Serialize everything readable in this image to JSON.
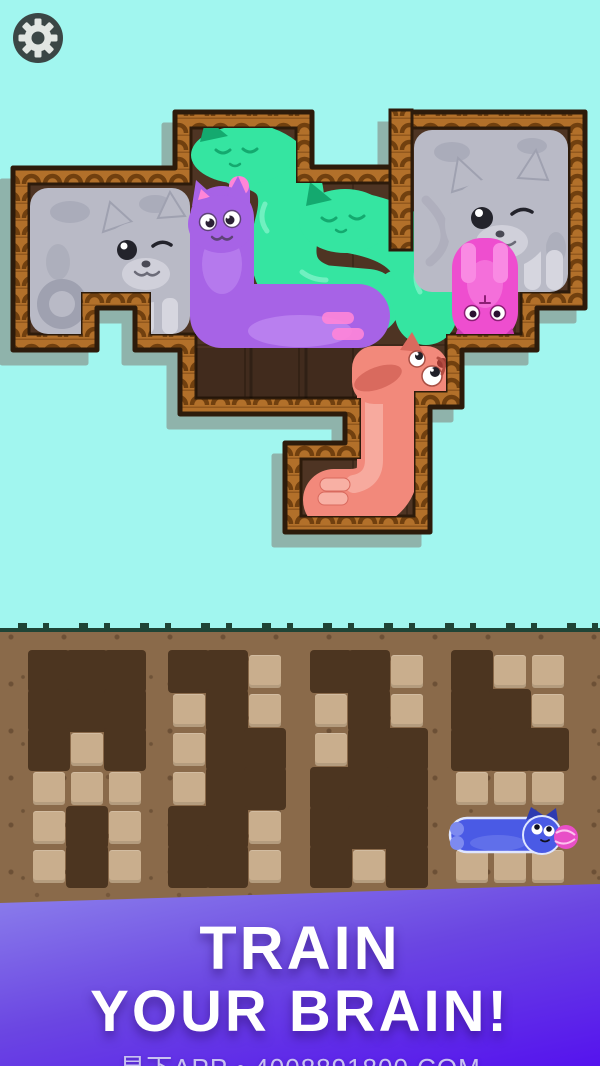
{
  "toolbar": {
    "settings_icon": "gear"
  },
  "banner": {
    "line1": "TRAIN",
    "line2": "YOUR BRAIN!",
    "subtext": "易下APP • 4008891800.COM"
  },
  "colors": {
    "sky": "#a1f6ef",
    "shadow": "#8fb3ab",
    "wood": "#b2702a",
    "wood-dark": "#71400f",
    "wood-outline": "#2d1b0b",
    "board": "#4e3423",
    "gray": "#b9bac6",
    "gray-dark": "#9fa1b0",
    "gray-light": "#d6d6df",
    "teal": "#35e5a1",
    "teal-dark": "#14a96f",
    "teal-light": "#7ff2c8",
    "purple": "#a763e6",
    "purple-light": "#c18cf2",
    "pink-accent": "#ff85d8",
    "pinkcat": "#ee4ecf",
    "pinkcat-light": "#f98ae3",
    "salmon": "#f2897b",
    "salmon-dark": "#d96a5e",
    "salmon-light": "#f8b0a4",
    "blue": "#4a5ae5",
    "blue-dark": "#2e3bb0",
    "blue-light": "#7d8af0",
    "yarn": "#e84fc7",
    "dirt": "#8a6a4a",
    "dirt-dark": "#4c3520",
    "tile": "#c9ae8d",
    "grass": "#1f4436",
    "banner-top": "#8d82ec",
    "banner-mid": "#6b46e2",
    "banner-bottom": "#5513ee",
    "footer-text": "#c9c2f1",
    "gear-bg": "#3b4645",
    "gear-fg": "#e2e6e2"
  },
  "board": {
    "empty_middle_cells": 3,
    "pieces": [
      {
        "id": "gray-cat-left",
        "color_key": "gray"
      },
      {
        "id": "teal-cat-top",
        "color_key": "teal"
      },
      {
        "id": "purple-cat",
        "color_key": "purple"
      },
      {
        "id": "teal-cat-right",
        "color_key": "teal"
      },
      {
        "id": "gray-cat-right",
        "color_key": "gray"
      },
      {
        "id": "pink-cat",
        "color_key": "pinkcat"
      },
      {
        "id": "salmon-cat",
        "color_key": "salmon"
      },
      {
        "id": "blue-cat",
        "color_key": "blue"
      }
    ]
  },
  "ground": {
    "cell_w": 38,
    "cell_h": 39,
    "panel_top": 652,
    "panels": [
      {
        "id": "panel-1",
        "x": 30,
        "rows": [
          [
            "d",
            "d",
            "d"
          ],
          [
            "d",
            "d",
            "d"
          ],
          [
            "d",
            "t",
            "d"
          ],
          [
            "t",
            "t",
            "t"
          ],
          [
            "t",
            "d",
            "t"
          ],
          [
            "t",
            "d",
            "t"
          ]
        ]
      },
      {
        "id": "panel-2",
        "x": 170,
        "rows": [
          [
            "d",
            "d",
            "t"
          ],
          [
            "t",
            "d",
            "t"
          ],
          [
            "t",
            "d",
            "d"
          ],
          [
            "t",
            "d",
            "d"
          ],
          [
            "d",
            "d",
            "t"
          ],
          [
            "d",
            "d",
            "t"
          ]
        ]
      },
      {
        "id": "panel-3",
        "x": 312,
        "rows": [
          [
            "d",
            "d",
            "t"
          ],
          [
            "t",
            "d",
            "t"
          ],
          [
            "t",
            "d",
            "d"
          ],
          [
            "d",
            "d",
            "d"
          ],
          [
            "d",
            "d",
            "d"
          ],
          [
            "d",
            "t",
            "d"
          ]
        ]
      },
      {
        "id": "panel-4",
        "x": 453,
        "rows": [
          [
            "d",
            "t",
            "t"
          ],
          [
            "d",
            "d",
            "t"
          ],
          [
            "d",
            "d",
            "d"
          ],
          [
            "t",
            "t",
            "t"
          ],
          [
            "b",
            "b",
            "b"
          ],
          [
            "t",
            "t",
            "t"
          ]
        ]
      }
    ]
  }
}
